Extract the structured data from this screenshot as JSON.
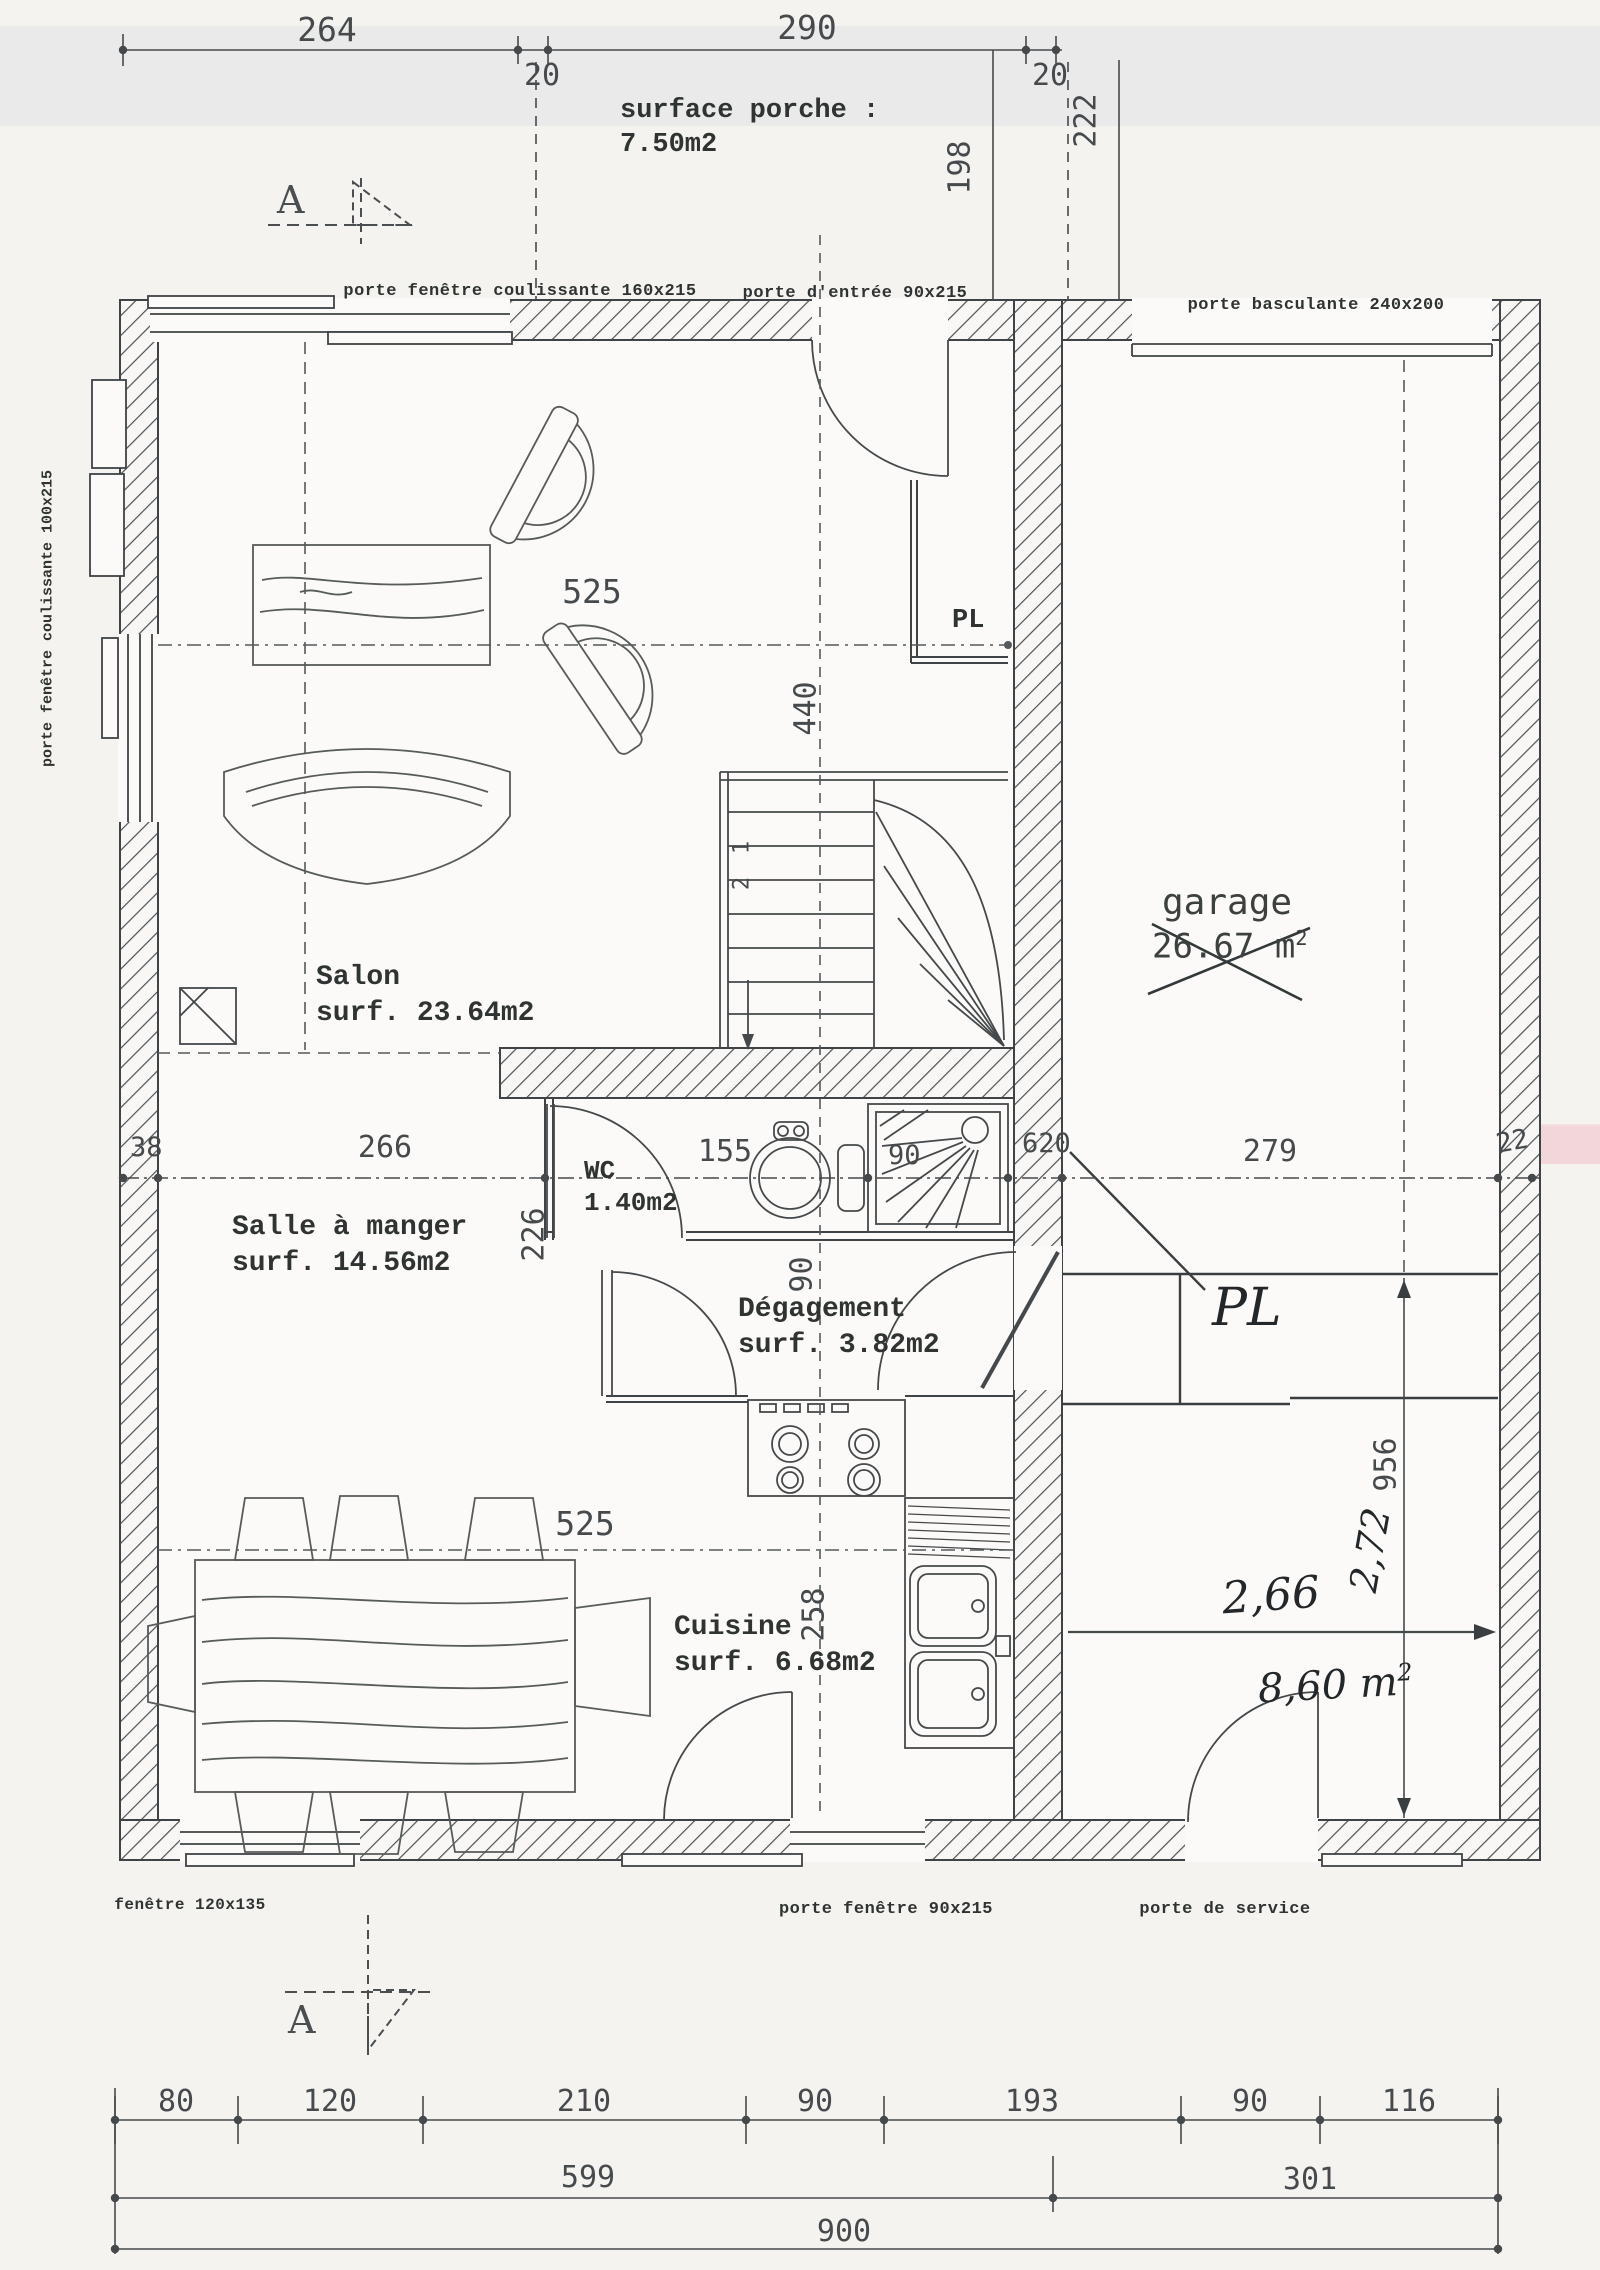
{
  "top_dims": {
    "d264": "264",
    "d20a": "20",
    "d290": "290",
    "d20b": "20",
    "d198": "198",
    "d222": "222"
  },
  "porch": {
    "line1": "surface porche :",
    "line2": "7.50m2"
  },
  "section": {
    "letter_top": "A",
    "letter_bottom": "A"
  },
  "openings": {
    "top_window": "porte fenêtre coulissante 160x215",
    "entry": "porte d'entrée 90x215",
    "garage_door": "porte basculante 240x200",
    "left_window": "porte fenêtre coulissante 100x215",
    "bottom_window": "fenêtre 120x135",
    "bottom_door_window": "porte fenêtre 90x215",
    "service_door": "porte de service"
  },
  "rooms": {
    "salon": {
      "name": "Salon",
      "area": "surf. 23.64m2"
    },
    "salle_a_manger": {
      "name": "Salle à manger",
      "area": "surf. 14.56m2"
    },
    "wc": {
      "name": "WC",
      "area": "1.40m2"
    },
    "degagement": {
      "name": "Dégagement",
      "area": "surf. 3.82m2"
    },
    "cuisine": {
      "name": "Cuisine",
      "area": "surf. 6.68m2"
    },
    "garage": {
      "name": "garage",
      "area": "26.67 m",
      "area_sup": "2"
    },
    "closet_top": "PL",
    "closet_hand": "PL"
  },
  "plan_dims": {
    "salon_width": "525",
    "hall_height": "440",
    "left_38": "38",
    "dining_266": "266",
    "wc_155": "155",
    "shower_90": "90",
    "mid_620": "620",
    "garage_279": "279",
    "wall_22": "22",
    "dining_depth": "226",
    "deg_90": "90",
    "table_525": "525",
    "kitchen_258": "258",
    "right_956": "956",
    "stair_1": "1",
    "stair_2": "2"
  },
  "handwritten": {
    "d266": "2,66",
    "d272": "2,72",
    "area": "8,60 m",
    "area_sup": "2"
  },
  "bottom_chain": {
    "row1": [
      "80",
      "120",
      "210",
      "90",
      "193",
      "90",
      "116"
    ],
    "row2": [
      "599",
      "301"
    ],
    "row3": [
      "900"
    ]
  }
}
